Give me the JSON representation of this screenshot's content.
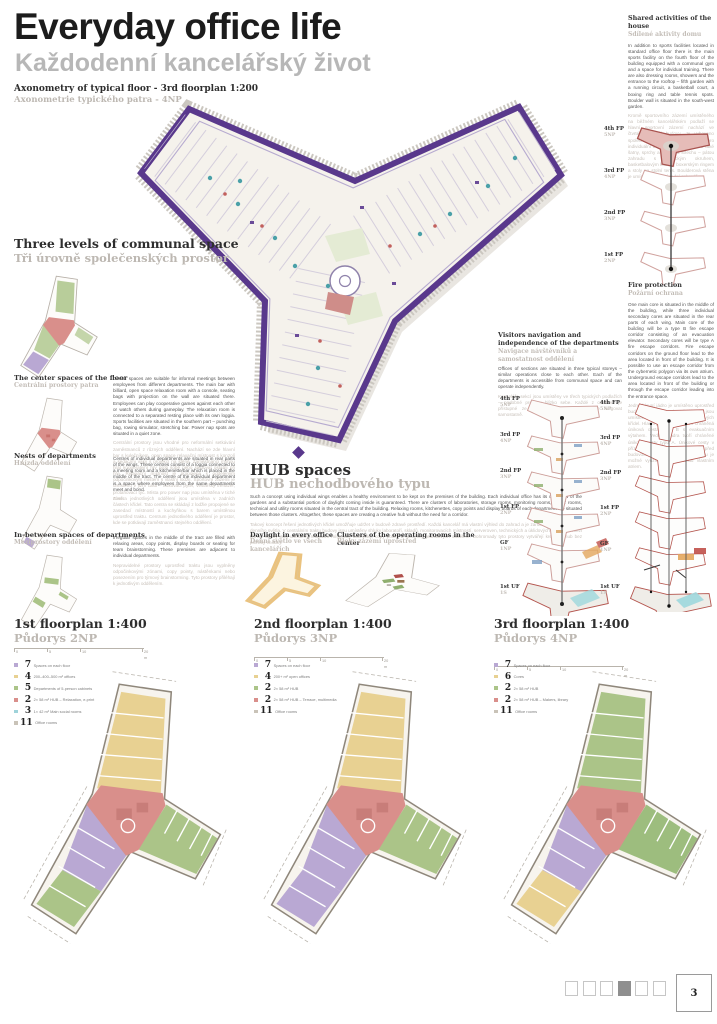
{
  "page": {
    "title": "Everyday office life",
    "subtitle": "Každodenní kancelářský život",
    "sheet_number": "3"
  },
  "palette": {
    "purple_outline": "#59388c",
    "red": "#d98f8b",
    "yellow": "#e8d192",
    "green": "#abc488",
    "lavender": "#b9a8d3",
    "cyan": "#9fd3da",
    "orange": "#eac27e",
    "gray_label": "#bdb8b2"
  },
  "axonometry": {
    "heading_en": "Axonometry of typical floor - 3rd floorplan 1:200",
    "heading_cz": "Axonometrie typického patra - 4NP"
  },
  "three_levels": {
    "heading_en": "Three levels of communal space",
    "heading_cz": "Tři úrovně společenských prostor",
    "items": [
      {
        "title_en": "The center spaces of the floor",
        "title_cz": "Centrální prostory patra",
        "text_en": "Center spaces are suitable for informal meetings between employees from different departments. The main bar with billiard, open space relaxation room with a console, seating bags with projection on the wall are situated there. Employees can play cooperative games against each other or watch others during gameplay. The relaxation room is connected to a separated resting place with its own loggia. Sports facilities are situated in the southern part – punching bag, rowing simulator, stretching bar. Power nap spots are situated in a quiet zone.",
        "text_cz": "Centrální prostory jsou vhodné pro neformální setkávání zaměstnanců z různých oddělení. Nachází se zde hlavní bar s kulečníkem, open space relaxační místnost s konzolí a sedacími vaky s projekcí na stěně. Zaměstnanci mohou hrát kooperativní hry proti sobě nebo sledovat ostatní při hře. Relaxační místnost je propojena s odděleným odpočinkovým místem s vlastní lodžií. Sportovní zázemí je umístěno v jižní části – boxovací pytel, veslařský trenažér, protahovací tyč. Místa pro power nap jsou umístěna v tiché zóně."
      },
      {
        "title_en": "Nests of departments",
        "title_cz": "Hnízda oddělení",
        "text_en": "Centres of individual departments are situated in rear parts of the wings. These centres consist of a loggia connected to a meeting room and a kitchenette/bar which is placed in the middle of the tract. The centre of the individual department is a space where employees from the same departments meet and bond.",
        "text_cz": "Centra jednotlivých oddělení jsou umístěna v zadních částech křídel. Tato centra se skládají z lodžie propojené se zasedací místností a kuchyňkou s barem umístěnou uprostřed traktu. Centrum jednotlivého oddělení je prostor, kde se potkávají zaměstnanci stejného oddělení."
      },
      {
        "title_en": "In-between spaces of departments",
        "title_cz": "Meziprostory oddělení",
        "text_en": "Irregular spaces in the middle of the tract are filled with relaxing areas, copy points, display boards or seating for team brainstorming. These premises are adjacent to individual departments.",
        "text_cz": "Nepravidelné prostory uprostřed traktu jsou vyplněny odpočinkovými zónami, copy pointy, nástěnkami nebo posezením pro týmový brainstorming. Tyto prostory přiléhají k jednotlivým oddělením."
      }
    ]
  },
  "hub": {
    "heading_en": "HUB spaces",
    "heading_cz": "HUB nechodbového typu",
    "text_en": "Such a concept using individual wings enables a healthy environment to be kept on the premises of the building. Each individual office has its own view of the gardens and a substantial portion of daylight coming inside is guaranteed. There are clusters of laboratories, storage rooms, monitoring rooms, server rooms, technical and utility rooms situated in the central tract of the building. Relaxing rooms, kitchenettes, copy points and display boards of each department are situated between those clusters. Altogether, these spaces are creating a creative hub without the need for a corridor.",
    "text_cz": "Takový koncept řešení jednotlivých křídel umožňuje udržet v budově zdravé prostředí. Každá kancelář má vlastní výhled do zahrad a je zaručen dostatečný podíl denního světla. V centrálním traktu budovy jsou umístěny shluky laboratoří, skladů, monitorovacích místností, serveroven, technických a úklidových místností. Mezi těmito shluky jsou umístěny relaxační místnosti, kuchyňky, copy pointy a nástěnky jednotlivých oddělení. Dohromady tyto prostory vytvářejí kreativní hub bez potřeby chodby.",
    "sub_left": {
      "title_en": "Daylight in every office",
      "title_cz": "Denní světlo ve všech kancelářích"
    },
    "sub_right": {
      "title_en": "Clusters of the operating rooms in the center",
      "title_cz": "Bloky zázemí uprostřed"
    }
  },
  "visitors": {
    "title_en": "Visitors navigation and independence of the departments",
    "title_cz": "Navigace návštěvníků a samostatnost oddělení",
    "text_en": "Offices of sections are situated in three typical storeys – similar operations close to each other. Each of the departments is accessible from communal space and can operate independently.",
    "text_cz": "Kanceláře sekcí jsou umístěny ve třech typických podlažích – podobné provozy blízko sebe. Každé z oddělení je přístupné ze společného prostoru a může fungovat samostatně."
  },
  "shared_activities": {
    "title_en": "Shared activities of the house",
    "title_cz": "Sdílené aktivity domu",
    "text_en": "In addition to sports facilities located in standard office floor there is the main sports facility on the fourth floor of the building equipped with a communal gym and a space for individual training. There are also dressing rooms, showers and the entrance to the rooftop – fifth garden with a running circuit, a basketball court, a boxing ring and table tennis spots. Boulder wall is situated in the south-west garden.",
    "text_cz": "Kromě sportovního zázemí umístěného na běžném kancelářském podlaží se hlavní sportovní zázemí nachází ve čtvrtém podlaží budovy. Je vybaveno společnou posilovnou a prostorem pro individuální trénink. Nachází se zde také šatny, sprchy a vstup na střechu – pátou zahradu s běžeckým okruhem, basketbalovým košem, boxerským ringem a stoly na stolní tenis. Boulderová stěna je umístěna v jihozápadní zahradě."
  },
  "fire_protection": {
    "title_en": "Fire protection",
    "title_cz": "Požární ochrana",
    "text_en": "One main core is situated in the middle of the building, while three individual secondary cores are situated in the rear parts of each wing. Main core of the building will be a type B fire escape corridor consisting of an evacuation elevator. Secondary cores will be type A fire escape corridors. Fire escape corridors on the ground floor lead to the area located in front of the building. It is possible to use an escape corridor from the cybernetic polygon via its own atrium. Underground escape corridors lead to the area located in front of the building or through the escape corridor leading into the entrance space.",
    "text_cz": "Jedno hlavní jádro je umístěno uprostřed budovy, tři samostatná vedlejší jádra jsou umístěna v zadních částech jednotlivých křídel. Hlavní jádro budovy tvoří chráněná úniková cesta typu B s evakuačním výtahem. Vedlejší jádra tvoří chráněné únikové cesty typu A. Únikové cesty v přízemí ústí na volné prostranství před budovou. Z kybernetického polygonu je možné využít únikovou cestu vlastním atriem."
  },
  "stacks": {
    "upper": [
      {
        "fp": "4th FP",
        "np": "5NP"
      },
      {
        "fp": "3rd FP",
        "np": "4NP"
      },
      {
        "fp": "2nd FP",
        "np": "3NP"
      },
      {
        "fp": "1st FP",
        "np": "2NP"
      }
    ],
    "full": [
      {
        "fp": "4th FP",
        "np": "5NP"
      },
      {
        "fp": "3rd FP",
        "np": "4NP"
      },
      {
        "fp": "2nd FP",
        "np": "3NP"
      },
      {
        "fp": "1st FP",
        "np": "2NP"
      },
      {
        "fp": "GF",
        "np": "1NP"
      },
      {
        "fp": "1st UF",
        "np": "1S"
      }
    ]
  },
  "scale_bar": {
    "t0": "0",
    "t1": "5",
    "t2": "10",
    "t3": "20 m"
  },
  "floorplans": [
    {
      "heading_en": "1st floorplan 1:400",
      "heading_cz": "Půdorys 2NP",
      "css": "--wt:#e8d192;--wr:#abc488;--wb:#b9a8d3;--wb2:#abc488;--ct:#d98f8b",
      "legend": [
        {
          "count": "7",
          "label": "Spaces on each floor"
        },
        {
          "count": "4",
          "label": "200–400–500 m² offices"
        },
        {
          "count": "5",
          "label": "Departments of 5-person cabinets"
        },
        {
          "count": "2",
          "label": "2× 58 m² HUB – Relaxation, e-print"
        },
        {
          "count": "3",
          "label": "1× 42 m² Main social rooms"
        },
        {
          "count": "11",
          "label": "Office rooms"
        }
      ]
    },
    {
      "heading_en": "2nd floorplan 1:400",
      "heading_cz": "Půdorys 3NP",
      "css": "--wt:#e8d192;--wr:#abc488;--wb:#b9a8d3;--wb2:#b9a8d3;--ct:#d98f8b",
      "legend": [
        {
          "count": "7",
          "label": "Spaces on each floor"
        },
        {
          "count": "4",
          "label": "200+ m² open offices"
        },
        {
          "count": "2",
          "label": "2× 58 m² HUB"
        },
        {
          "count": "2",
          "label": "2× 58 m² HUB – Terrace, multimedia"
        },
        {
          "count": "11",
          "label": "Office rooms"
        }
      ]
    },
    {
      "heading_en": "3rd floorplan 1:400",
      "heading_cz": "Půdorys 4NP",
      "css": "--wt:#abc488;--wr:#9dbd7e;--wb:#b9a8d3;--wb2:#e8d192;--ct:#d98f8b",
      "legend": [
        {
          "count": "7",
          "label": "Spaces on each floor"
        },
        {
          "count": "6",
          "label": "Cores"
        },
        {
          "count": "2",
          "label": "2× 58 m² HUB"
        },
        {
          "count": "2",
          "label": "2× 58 m² HUB – Makers, library"
        },
        {
          "count": "11",
          "label": "Office rooms"
        }
      ]
    }
  ],
  "pager": {
    "squares": 6,
    "active": 4
  }
}
